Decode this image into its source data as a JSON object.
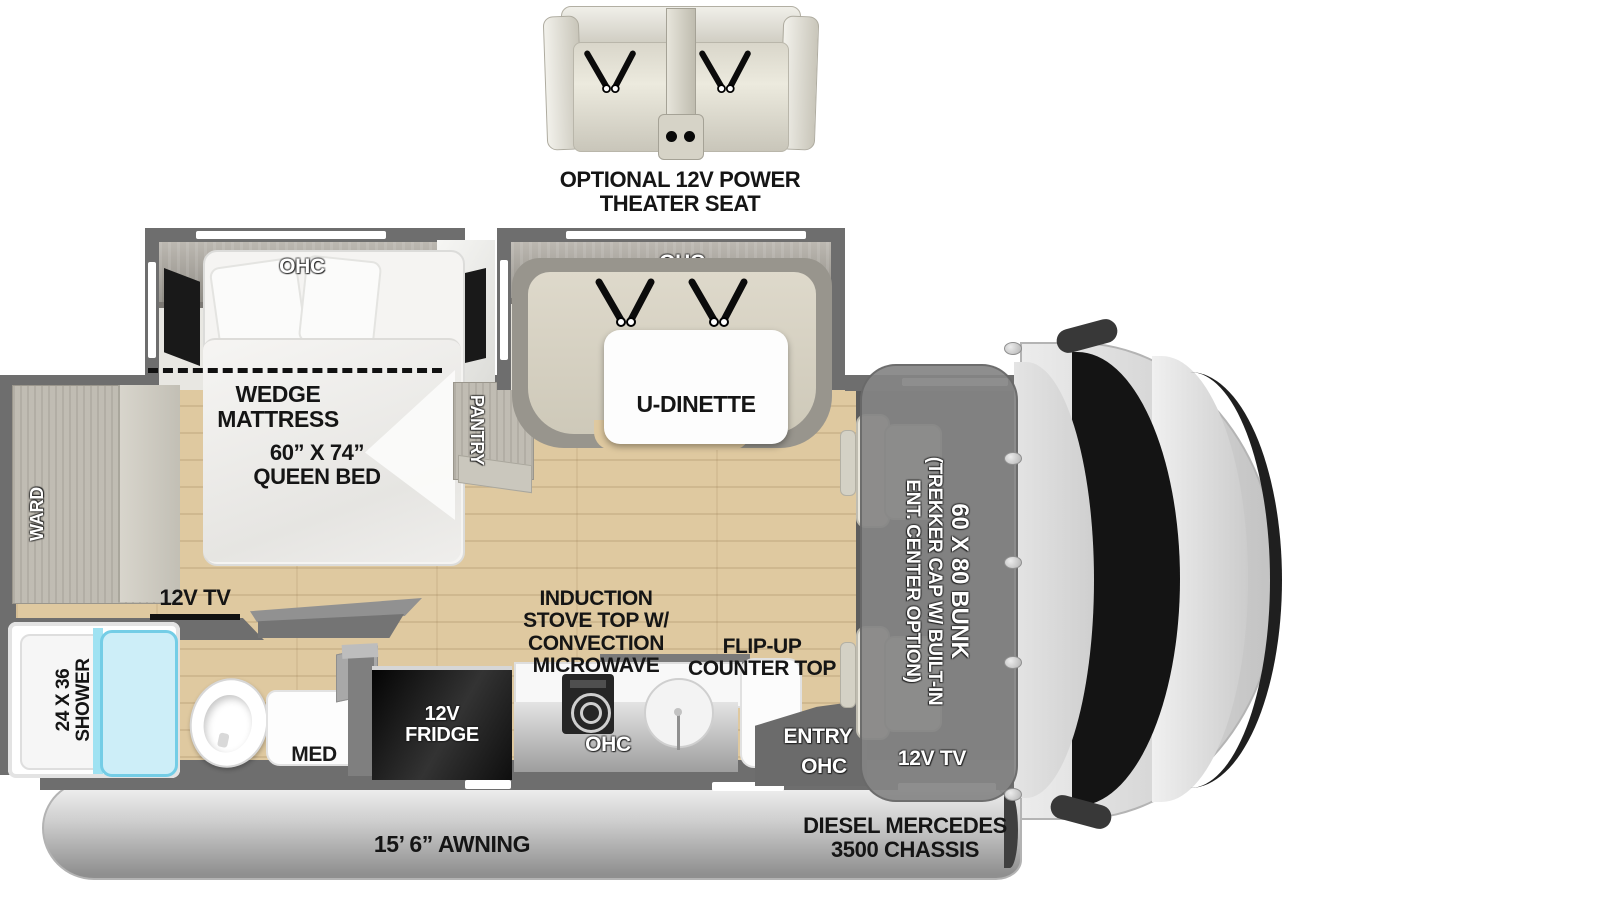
{
  "theater_seat": {
    "label": "OPTIONAL 12V POWER THEATER SEAT"
  },
  "bedroom": {
    "ohc": "OHC",
    "wedge_mattress": "WEDGE MATTRESS",
    "queen_bed": "60” X 74”\nQUEEN BED",
    "ward": "WARD",
    "pantry": "PANTRY",
    "tv": "12V TV"
  },
  "dinette": {
    "ohc": "OHC",
    "label": "U-DINETTE"
  },
  "bathroom": {
    "shower": "24 X 36\nSHOWER",
    "med": "MED"
  },
  "kitchen": {
    "stove": "INDUCTION\nSTOVE TOP W/\nCONVECTION\nMICROWAVE",
    "flip_up": "FLIP-UP\nCOUNTER TOP",
    "fridge": "12V\nFRIDGE",
    "ohc": "OHC"
  },
  "entry": {
    "label": "ENTRY",
    "ohc": "OHC"
  },
  "cab": {
    "bunk_line1": "60 X 80 BUNK",
    "bunk_line2": "(TREKKER CAP W/ BUILT-IN",
    "bunk_line3": "ENT. CENTER OPTION)",
    "tv": "12V TV"
  },
  "bottom": {
    "awning": "15’ 6” AWNING",
    "chassis": "DIESEL MERCEDES\n3500 CHASSIS"
  }
}
